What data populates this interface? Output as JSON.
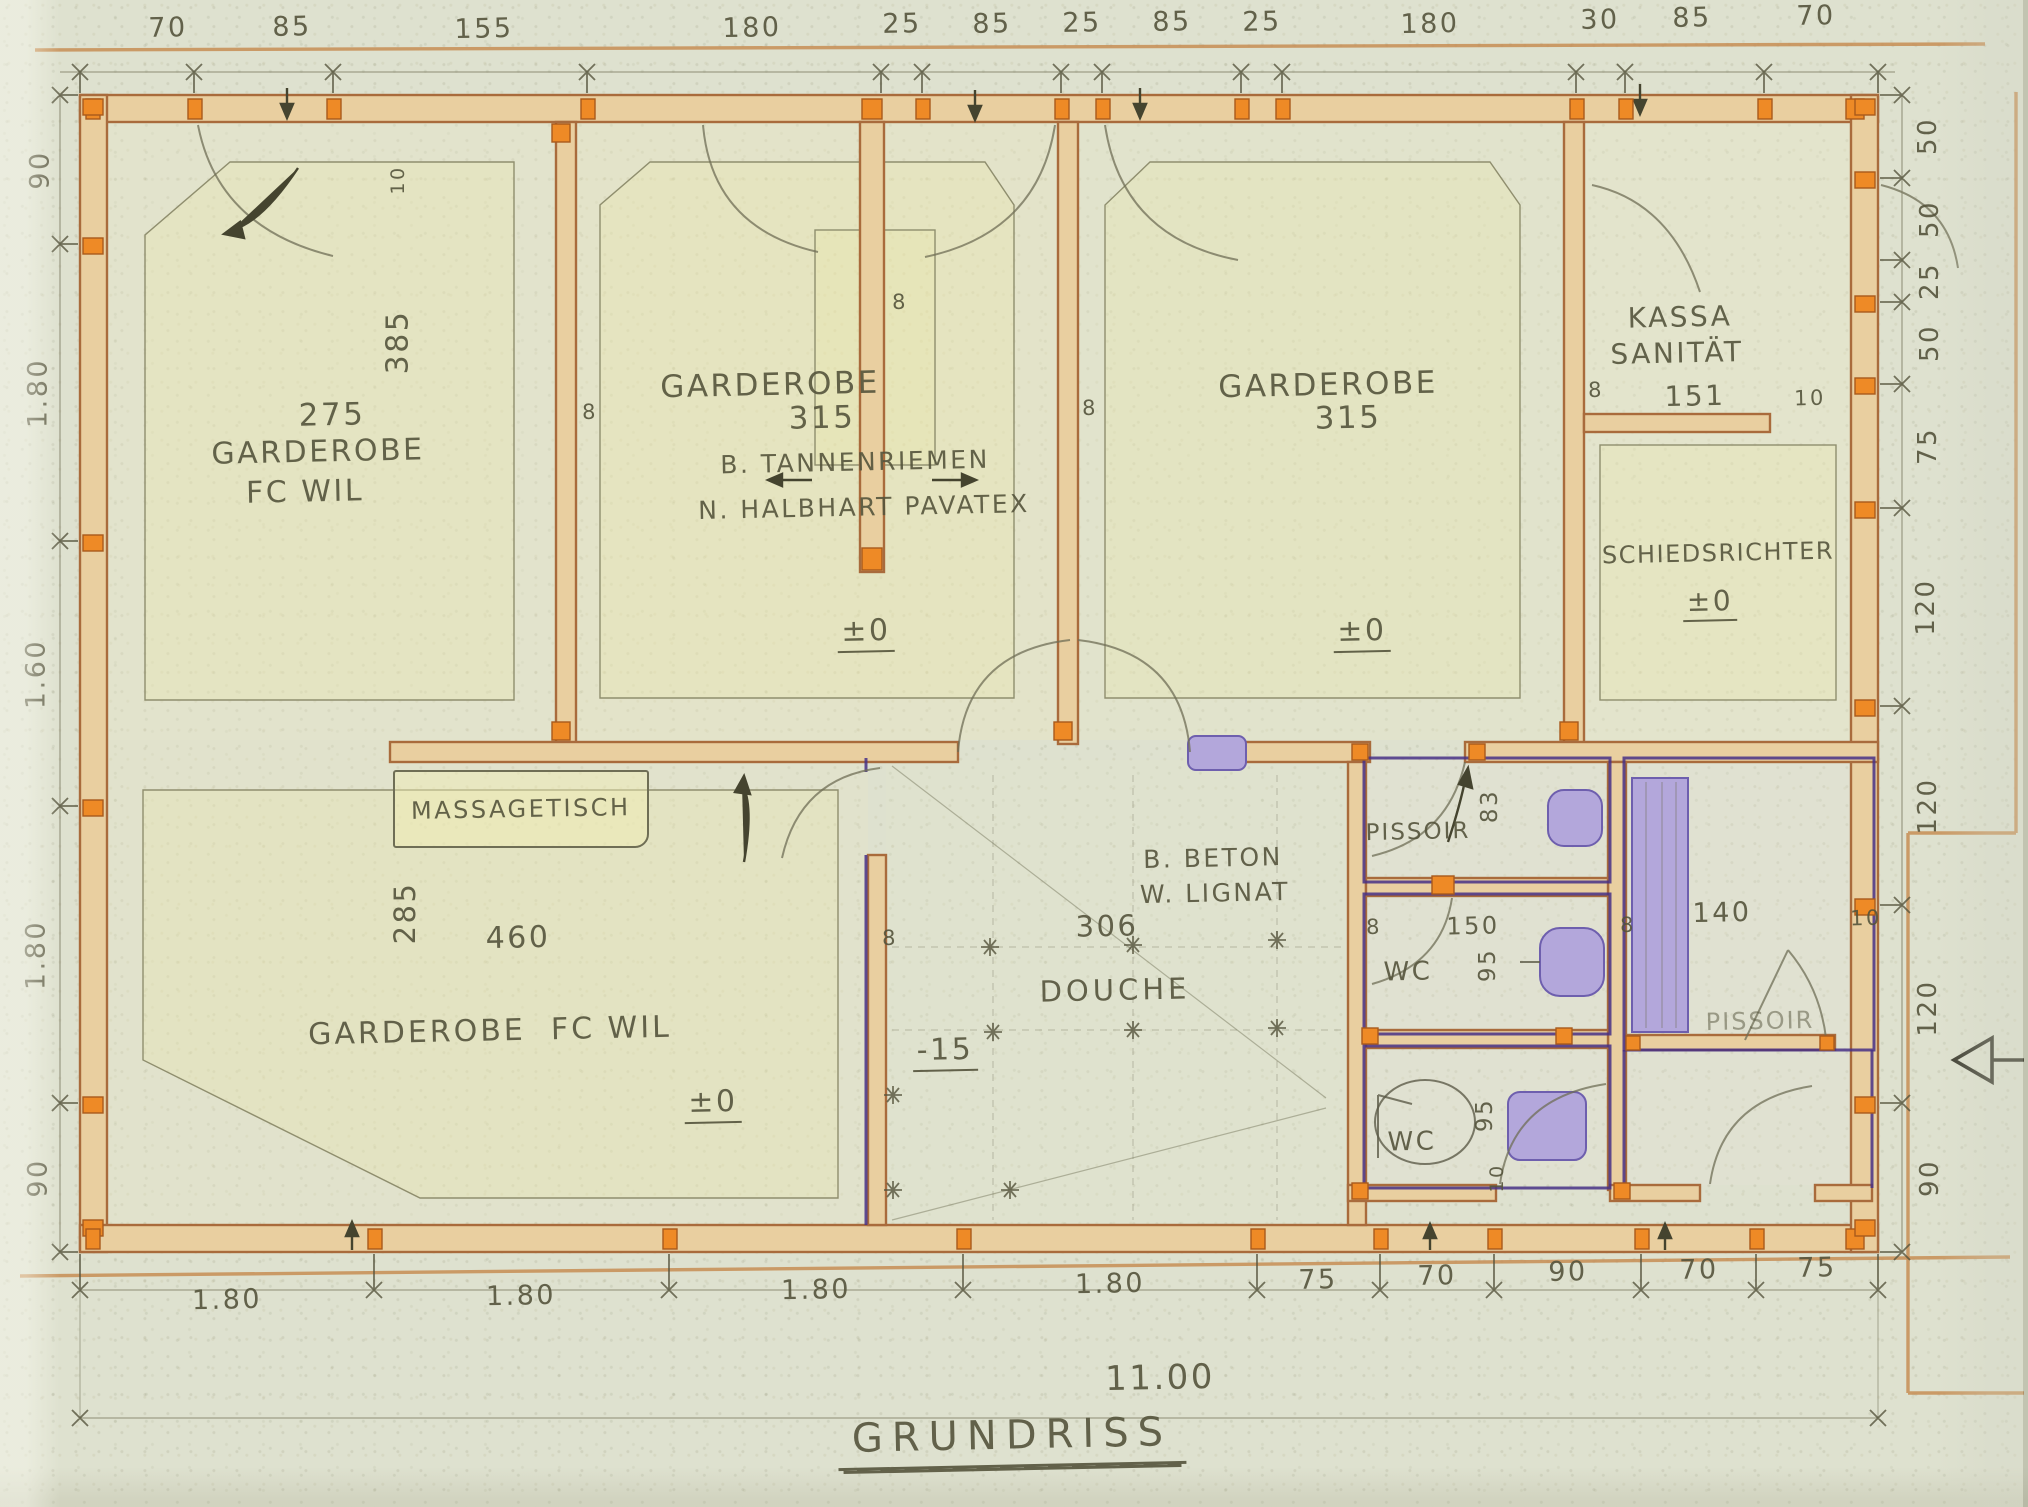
{
  "drawing": {
    "title": "GRUNDRISS",
    "overall": "11.00"
  },
  "dims": {
    "top": [
      "70",
      "85",
      "155",
      "180",
      "25",
      "85",
      "25",
      "85",
      "25",
      "180",
      "30",
      "85",
      "70"
    ],
    "left": [
      "90",
      "1.80",
      "1.60",
      "1.80",
      "90"
    ],
    "right": [
      "50",
      "50",
      "25",
      "50",
      "75",
      "120",
      "120",
      "120",
      "90"
    ],
    "bottom": [
      "1.80",
      "1.80",
      "1.80",
      "1.80",
      "75",
      "70",
      "90",
      "70",
      "75"
    ]
  },
  "marks": {
    "eight": "8",
    "ten": "10"
  },
  "rooms": {
    "garderobe_ul": {
      "number": "275",
      "name": "GARDEROBE",
      "team": "FC WIL",
      "depth": "385"
    },
    "garderobe_mid": {
      "name": "GARDEROBE",
      "number": "315",
      "material_b": "B. TANNENRIEMEN",
      "material_n": "N. HALBHART PAVATEX",
      "level": "±0"
    },
    "garderobe_right": {
      "name": "GARDEROBE",
      "number": "315",
      "level": "±0"
    },
    "kassa": {
      "name_line1": "KASSA",
      "name_line2": "SANITÄT",
      "number": "151"
    },
    "schiedsrichter": {
      "name": "SCHIEDSRICHTER",
      "level": "±0"
    },
    "garderobe_ll": {
      "name": "GARDEROBE  FC WIL",
      "width": "460",
      "depth": "285",
      "level": "±0"
    },
    "massage": {
      "label": "MASSAGETISCH"
    },
    "douche": {
      "name": "DOUCHE",
      "width": "306",
      "material_b": "B. BETON",
      "material_w": "W. LIGNAT",
      "level": "-15"
    },
    "pissoir_small": {
      "name": "PISSOIR",
      "depth": "83"
    },
    "wc_top": {
      "name": "WC",
      "width": "150",
      "depth": "95"
    },
    "wc_bottom": {
      "name": "WC",
      "depth": "95",
      "door": "10"
    },
    "pissoir_large": {
      "name": "PISSOIR",
      "width": "140",
      "gap": "10"
    }
  },
  "palette": {
    "paper": "#dee1cf",
    "wall_fill": "#e9cfa0",
    "wall_edge": "#a96b3c",
    "pier_orange": "#ee8a26",
    "sanitary_purple": "#463086",
    "fixture_violet": "#b3a7db",
    "pencil": "#6f6e55",
    "ink": "#55543c",
    "guide_orange": "#c78d54"
  }
}
